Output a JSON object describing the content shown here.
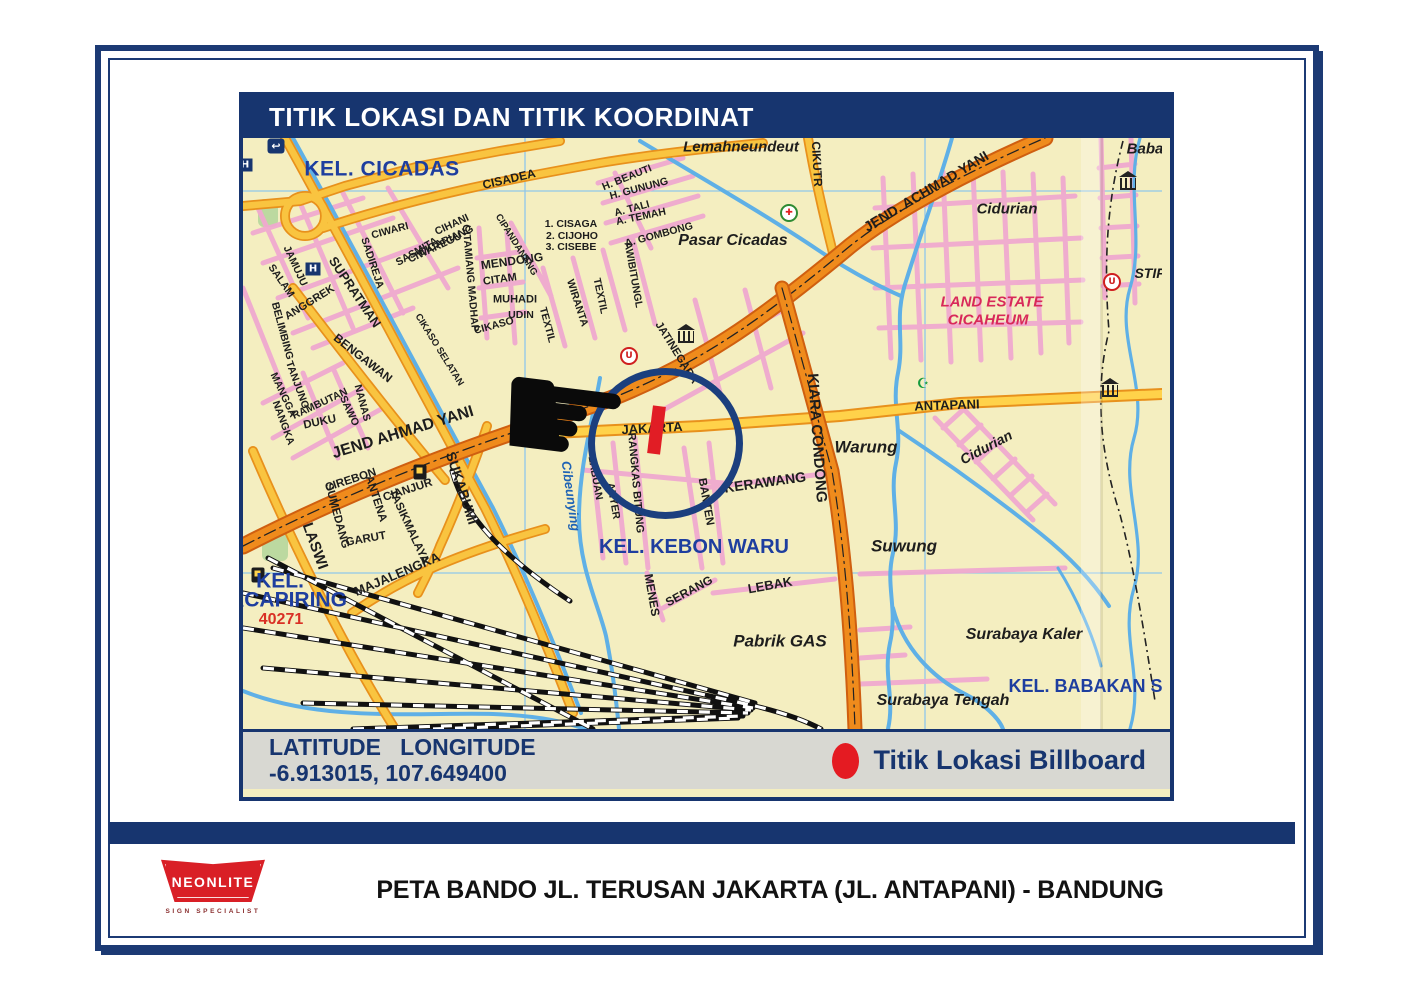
{
  "panel": {
    "header": {
      "title": "TITIK LOKASI DAN TITIK KOORDINAT"
    },
    "footer": {
      "coords_label": "LATITUDE   LONGITUDE",
      "coords_value": "-6.913015, 107.649400",
      "legend_label": "Titik Lokasi Billboard",
      "legend_dot_color": "#e41b22"
    }
  },
  "caption": "PETA BANDO JL. TERUSAN JAKARTA (JL. ANTAPANI) - BANDUNG",
  "logo": {
    "name": "NEONLITE",
    "tagline": "SIGN SPECIALIST",
    "color": "#d91f26"
  },
  "colors": {
    "navy": "#17356f",
    "map_bg": "#f4eec0",
    "kel_blue": "#1e3e9f",
    "crimson": "#d8295a",
    "red": "#d93025",
    "river_blue": "#5fb0e6",
    "road_orange": "#ef8b1c",
    "road_yellow": "#f9c440",
    "street_pink": "#efa9cf"
  },
  "map": {
    "labels": [
      {
        "t": "KEL. CICADAS",
        "x": 139,
        "y": 31,
        "s": 21,
        "c": "#1e3e9f",
        "sp": 0.5
      },
      {
        "t": "CISADEA",
        "x": 266,
        "y": 41,
        "r": -13,
        "s": 12
      },
      {
        "t": "Lemahneundeut",
        "x": 498,
        "y": 9,
        "s": 15,
        "i": 1
      },
      {
        "t": "CIKUTR",
        "x": 574,
        "y": 26,
        "r": 87,
        "s": 12
      },
      {
        "t": "H. BEAUTI",
        "x": 384,
        "y": 40,
        "r": -22,
        "s": 10.5
      },
      {
        "t": "H. GUNUNG",
        "x": 396,
        "y": 51,
        "r": -15,
        "s": 10.5
      },
      {
        "t": "A. TALI",
        "x": 389,
        "y": 71,
        "r": -15,
        "s": 10.5
      },
      {
        "t": "A. TEMAH",
        "x": 398,
        "y": 79,
        "r": -12,
        "s": 10.5
      },
      {
        "t": "A. GOMBONG",
        "x": 416,
        "y": 97,
        "r": -15,
        "s": 10.5
      },
      {
        "t": "1. CISAGA",
        "x": 328,
        "y": 86,
        "s": 10.5
      },
      {
        "t": "2. CIJOHO",
        "x": 329,
        "y": 98,
        "s": 10.5
      },
      {
        "t": "3. CISEBE",
        "x": 328,
        "y": 109,
        "s": 10.5
      },
      {
        "t": "Pasar Cicadas",
        "x": 490,
        "y": 103,
        "s": 16,
        "i": 1
      },
      {
        "t": "JEND. ACHMAD YANI",
        "x": 683,
        "y": 53,
        "r": -31,
        "s": 14
      },
      {
        "t": "Cidurian",
        "x": 764,
        "y": 71,
        "s": 15,
        "i": 1
      },
      {
        "t": "Baba",
        "x": 902,
        "y": 11,
        "s": 15,
        "i": 1
      },
      {
        "t": "LAND ESTATE",
        "x": 749,
        "y": 164,
        "s": 15,
        "i": 1,
        "c": "#d8295a"
      },
      {
        "t": "CICAHEUM",
        "x": 745,
        "y": 182,
        "s": 15,
        "i": 1,
        "c": "#d8295a"
      },
      {
        "t": "STIP",
        "x": 907,
        "y": 135,
        "s": 14,
        "i": 1
      },
      {
        "t": "CIWARI",
        "x": 147,
        "y": 93,
        "r": -15,
        "s": 10.5
      },
      {
        "t": "CIHANI",
        "x": 209,
        "y": 87,
        "r": -25,
        "s": 10.5
      },
      {
        "t": "CICARIANG",
        "x": 203,
        "y": 103,
        "r": -25,
        "s": 10.5
      },
      {
        "t": "CIWAREGU",
        "x": 192,
        "y": 110,
        "r": -25,
        "s": 10.5
      },
      {
        "t": "SASMITA",
        "x": 174,
        "y": 114,
        "r": -30,
        "s": 10.5
      },
      {
        "t": "SADIREJA",
        "x": 129,
        "y": 125,
        "r": 72,
        "s": 10.5
      },
      {
        "t": "CITAMIANG MADHAP",
        "x": 227,
        "y": 140,
        "r": 85,
        "s": 10.5
      },
      {
        "t": "CIPANDANANG",
        "x": 273,
        "y": 107,
        "r": 58,
        "s": 9.5
      },
      {
        "t": "MENDONG",
        "x": 269,
        "y": 123,
        "r": -8,
        "s": 12
      },
      {
        "t": "CITAM",
        "x": 257,
        "y": 142,
        "r": -8,
        "s": 11
      },
      {
        "t": "MUHADI",
        "x": 272,
        "y": 162,
        "s": 11
      },
      {
        "t": "UDIN",
        "x": 278,
        "y": 177,
        "s": 10.5
      },
      {
        "t": "CIKASO",
        "x": 251,
        "y": 188,
        "r": -15,
        "s": 10.5
      },
      {
        "t": "CIKASO SELATAN",
        "x": 196,
        "y": 212,
        "r": 58,
        "s": 9.5
      },
      {
        "t": "TEXTIL",
        "x": 304,
        "y": 187,
        "r": 75,
        "s": 10.5
      },
      {
        "t": "WIRANTA",
        "x": 334,
        "y": 165,
        "r": 72,
        "s": 10.5
      },
      {
        "t": "TEXTIL",
        "x": 357,
        "y": 158,
        "r": 78,
        "s": 10.5
      },
      {
        "t": "AWIBITUNGL",
        "x": 390,
        "y": 137,
        "r": 80,
        "s": 10.5
      },
      {
        "t": "JATINEGARA",
        "x": 433,
        "y": 215,
        "r": 58,
        "s": 11
      },
      {
        "t": "SUPRATMAN",
        "x": 112,
        "y": 154,
        "r": 56,
        "s": 13
      },
      {
        "t": "JAMUJU",
        "x": 52,
        "y": 128,
        "r": 65,
        "s": 10.5
      },
      {
        "t": "SALAM",
        "x": 38,
        "y": 143,
        "r": 55,
        "s": 10.5
      },
      {
        "t": "ANGGREK",
        "x": 67,
        "y": 165,
        "r": -32,
        "s": 11
      },
      {
        "t": "BELIMBING",
        "x": 39,
        "y": 193,
        "r": 75,
        "s": 10.5
      },
      {
        "t": "BENGAWAN",
        "x": 120,
        "y": 220,
        "r": 38,
        "s": 12
      },
      {
        "t": "TANJUNG",
        "x": 54,
        "y": 247,
        "r": 70,
        "s": 10.5
      },
      {
        "t": "MANGGA",
        "x": 40,
        "y": 257,
        "r": 65,
        "s": 10.5
      },
      {
        "t": "NANGKA",
        "x": 40,
        "y": 285,
        "r": 70,
        "s": 10.5
      },
      {
        "t": "RAMBUTAN",
        "x": 77,
        "y": 266,
        "r": -25,
        "s": 10.5
      },
      {
        "t": "SAWO",
        "x": 106,
        "y": 273,
        "r": 65,
        "s": 10.5
      },
      {
        "t": "NANAS",
        "x": 119,
        "y": 265,
        "r": 75,
        "s": 10.5
      },
      {
        "t": "DUKU",
        "x": 77,
        "y": 285,
        "r": -12,
        "s": 11.5
      },
      {
        "t": "JEND AHMAD YANI",
        "x": 160,
        "y": 295,
        "r": -17,
        "s": 16
      },
      {
        "t": "CIREBON",
        "x": 108,
        "y": 343,
        "r": -18,
        "s": 11.5
      },
      {
        "t": "ANTENA",
        "x": 132,
        "y": 361,
        "r": 72,
        "s": 11.5
      },
      {
        "t": "SUMEDANG",
        "x": 93,
        "y": 378,
        "r": 75,
        "s": 11.5
      },
      {
        "t": "CIANJUR",
        "x": 165,
        "y": 353,
        "r": -18,
        "s": 11.5
      },
      {
        "t": "TASIKMALAYA",
        "x": 165,
        "y": 389,
        "r": 65,
        "s": 11.5
      },
      {
        "t": "GARUT",
        "x": 123,
        "y": 402,
        "r": -10,
        "s": 11.5
      },
      {
        "t": "LASWI",
        "x": 72,
        "y": 408,
        "r": 70,
        "s": 15
      },
      {
        "t": "SUKABUMI",
        "x": 219,
        "y": 350,
        "r": 72,
        "s": 14
      },
      {
        "t": "MAJALENGKA",
        "x": 154,
        "y": 436,
        "r": -23,
        "s": 13
      },
      {
        "t": "KEL.",
        "x": 37,
        "y": 443,
        "s": 21,
        "c": "#1e3e9f"
      },
      {
        "t": "ACAPIRING",
        "x": 45,
        "y": 462,
        "s": 21,
        "c": "#1e3e9f"
      },
      {
        "t": "40271",
        "x": 38,
        "y": 482,
        "s": 16,
        "c": "#d93025"
      },
      {
        "t": "JAKARTA",
        "x": 409,
        "y": 290,
        "r": -3,
        "s": 13
      },
      {
        "t": "ANTAPANI",
        "x": 704,
        "y": 267,
        "r": -2,
        "s": 13
      },
      {
        "t": "KIARA CONDONG",
        "x": 574,
        "y": 300,
        "r": 86,
        "s": 15
      },
      {
        "t": "Warung",
        "x": 623,
        "y": 309,
        "s": 17,
        "i": 1
      },
      {
        "t": "Cidurian",
        "x": 743,
        "y": 309,
        "r": -28,
        "s": 14,
        "i": 1
      },
      {
        "t": "Suwung",
        "x": 661,
        "y": 408,
        "s": 17,
        "i": 1
      },
      {
        "t": "KEL. KEBON WARU",
        "x": 451,
        "y": 409,
        "s": 20,
        "c": "#1e3e9f"
      },
      {
        "t": "Cibeunying",
        "x": 328,
        "y": 358,
        "r": 82,
        "s": 13,
        "i": 1,
        "c": "#1f63b5"
      },
      {
        "t": "LABUAN",
        "x": 352,
        "y": 340,
        "r": 80,
        "s": 10.5
      },
      {
        "t": "ANYER",
        "x": 370,
        "y": 363,
        "r": 80,
        "s": 10.5
      },
      {
        "t": "RANGKAS BITUNG",
        "x": 392,
        "y": 345,
        "r": 85,
        "s": 11
      },
      {
        "t": "BANTEN",
        "x": 462,
        "y": 364,
        "r": 80,
        "s": 11.5
      },
      {
        "t": "KERAWANG",
        "x": 522,
        "y": 344,
        "r": -8,
        "s": 14
      },
      {
        "t": "MENES",
        "x": 409,
        "y": 457,
        "r": 80,
        "s": 12
      },
      {
        "t": "SERANG",
        "x": 446,
        "y": 453,
        "r": -28,
        "s": 12
      },
      {
        "t": "LEBAK",
        "x": 527,
        "y": 447,
        "r": -10,
        "s": 13
      },
      {
        "t": "Pabrik GAS",
        "x": 537,
        "y": 503,
        "s": 17,
        "i": 1
      },
      {
        "t": "Surabaya Kaler",
        "x": 781,
        "y": 497,
        "s": 16,
        "i": 1
      },
      {
        "t": "KEL. BABAKAN SU",
        "x": 849,
        "y": 548,
        "s": 18,
        "c": "#1e3e9f"
      },
      {
        "t": "Surabaya Tengah",
        "x": 700,
        "y": 563,
        "s": 16,
        "i": 1
      }
    ],
    "icons": [
      {
        "type": "u-turn",
        "x": 33,
        "y": 8
      },
      {
        "type": "hospital",
        "x": 2,
        "y": 27
      },
      {
        "type": "hospital",
        "x": 70,
        "y": 131
      },
      {
        "type": "red-cross",
        "x": 546,
        "y": 75
      },
      {
        "type": "bank",
        "x": 443,
        "y": 193
      },
      {
        "type": "bank",
        "x": 867,
        "y": 229
      },
      {
        "type": "bank",
        "x": 885,
        "y": 4
      },
      {
        "type": "u-marker",
        "x": 386,
        "y": 218
      },
      {
        "type": "u-marker",
        "x": 869,
        "y": 144
      },
      {
        "type": "mosque",
        "x": 680,
        "y": 246
      },
      {
        "type": "gas",
        "x": 15,
        "y": 383
      },
      {
        "type": "gas",
        "x": 177,
        "y": 265
      },
      {
        "type": "gas",
        "x": 589,
        "y": 538
      }
    ]
  }
}
